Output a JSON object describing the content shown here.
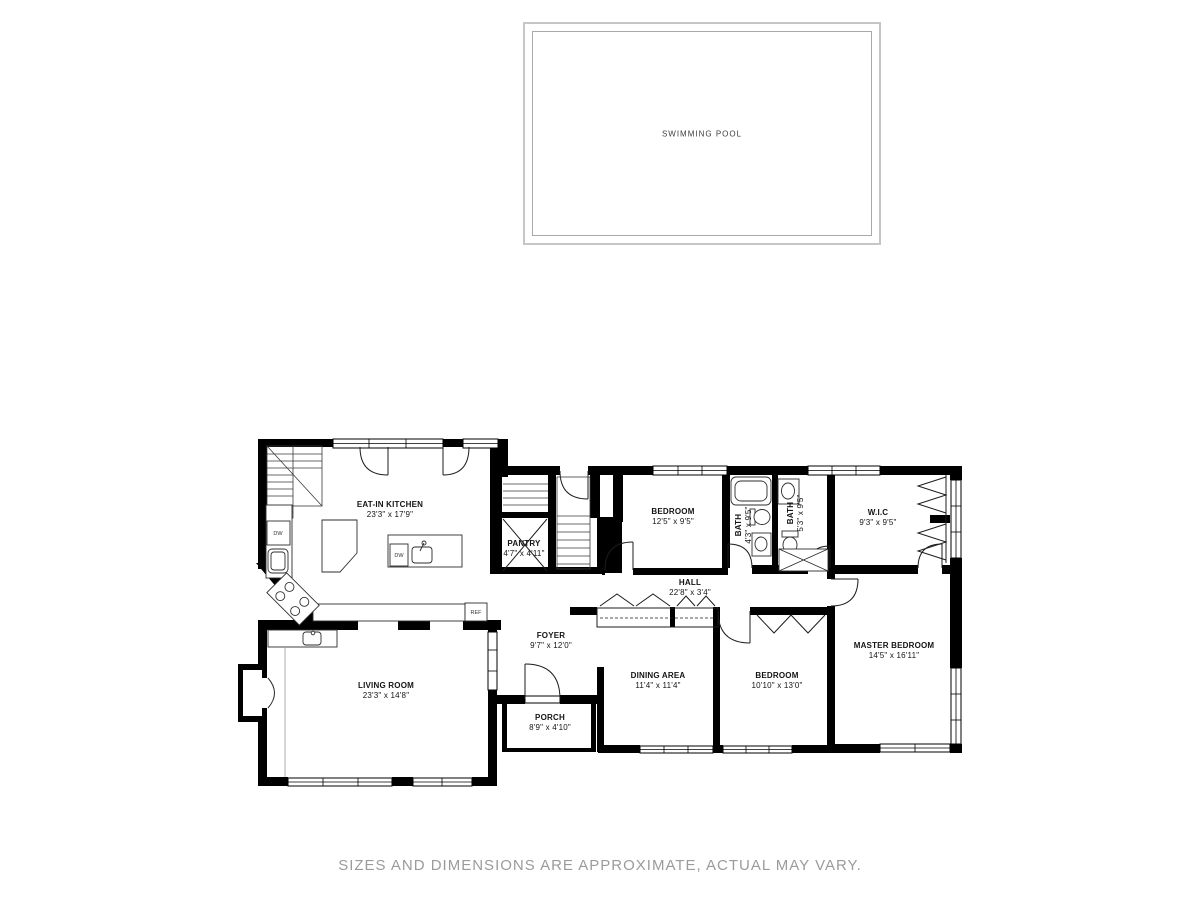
{
  "pool": {
    "label": "SWIMMING POOL"
  },
  "floor_plan": {
    "rooms": {
      "kitchen": {
        "name": "EAT-IN KITCHEN",
        "dims": "23'3\" x 17'9\""
      },
      "pantry": {
        "name": "PANTRY",
        "dims": "4'7\" x 4'11\""
      },
      "bedroom1": {
        "name": "BEDROOM",
        "dims": "12'5\" x 9'5\""
      },
      "bath1": {
        "name": "BATH",
        "dims": "4'3\" x 9'5\""
      },
      "bath2": {
        "name": "BATH",
        "dims": "5'3\" x 9'5\""
      },
      "wic": {
        "name": "W.I.C",
        "dims": "9'3\" x 9'5\""
      },
      "hall": {
        "name": "HALL",
        "dims": "22'8\" x 3'4\""
      },
      "foyer": {
        "name": "FOYER",
        "dims": "9'7\" x 12'0\""
      },
      "dining": {
        "name": "DINING AREA",
        "dims": "11'4\" x 11'4\""
      },
      "bedroom2": {
        "name": "BEDROOM",
        "dims": "10'10\" x 13'0\""
      },
      "master": {
        "name": "MASTER BEDROOM",
        "dims": "14'5\" x 16'11\""
      },
      "living": {
        "name": "LIVING ROOM",
        "dims": "23'3\" x 14'8\""
      },
      "porch": {
        "name": "PORCH",
        "dims": "8'9\" x 4'10\""
      }
    },
    "fixtures": {
      "dw": "DW",
      "ref": "REF"
    }
  },
  "footer": {
    "disclaimer": "SIZES AND DIMENSIONS ARE APPROXIMATE, ACTUAL MAY VARY."
  },
  "colors": {
    "walls": "#000000",
    "thin": "#2e2e2e",
    "pool_border": "#c6c6c6",
    "disclaimer": "#9b9b9b"
  }
}
